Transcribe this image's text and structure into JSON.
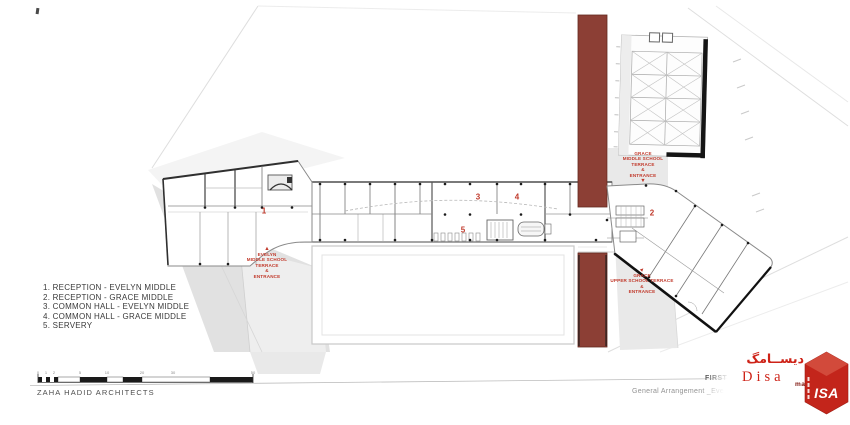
{
  "legend": {
    "items": [
      "1. RECEPTION - EVELYN MIDDLE",
      "2. RECEPTION - GRACE MIDDLE",
      "3. COMMON HALL - EVELYN MIDDLE",
      "4. COMMON HALL - GRACE MIDDLE",
      "5. SERVERY"
    ]
  },
  "plan": {
    "rooms": [
      {
        "num": "1"
      },
      {
        "num": "2"
      },
      {
        "num": "3"
      },
      {
        "num": "4"
      },
      {
        "num": "5"
      }
    ],
    "annotations": [
      {
        "name": "evelyn-middle-entrance",
        "arrow": "up",
        "lines": [
          "EVELYN",
          "MIDDLE SCHOOL",
          "TERRACE",
          "&",
          "ENTRANCE"
        ]
      },
      {
        "name": "grace-middle-entrance",
        "arrow": "down",
        "lines": [
          "GRACE",
          "MIDDLE SCHOOL",
          "TERRACE",
          "&",
          "ENTRANCE"
        ]
      },
      {
        "name": "grace-upper-entrance",
        "arrow": "ne",
        "lines": [
          "GRACE",
          "UPPER SCHOOL TERRACE",
          "&",
          "ENTRANCE"
        ]
      }
    ],
    "icons": {
      "up": "▲",
      "down": "▼",
      "ne": "▲"
    },
    "colors": {
      "link_band": "#8c3f35",
      "annotation_red": "#c13a2c"
    }
  },
  "footer": {
    "architect": "ZAHA HADID ARCHITECTS",
    "drawing_title": "FIRST FLOOR PLAN",
    "drawing_subtitle": "General Arrangement _Eve",
    "scale_labels": [
      "0",
      "1",
      "2",
      "5",
      "10",
      "20",
      "30",
      "50"
    ]
  },
  "brand": {
    "arabic": "دیســامگ",
    "name": "Disa",
    "suffix": "mag",
    "cube_text": "ISA",
    "logo_red": "#c3251b"
  }
}
